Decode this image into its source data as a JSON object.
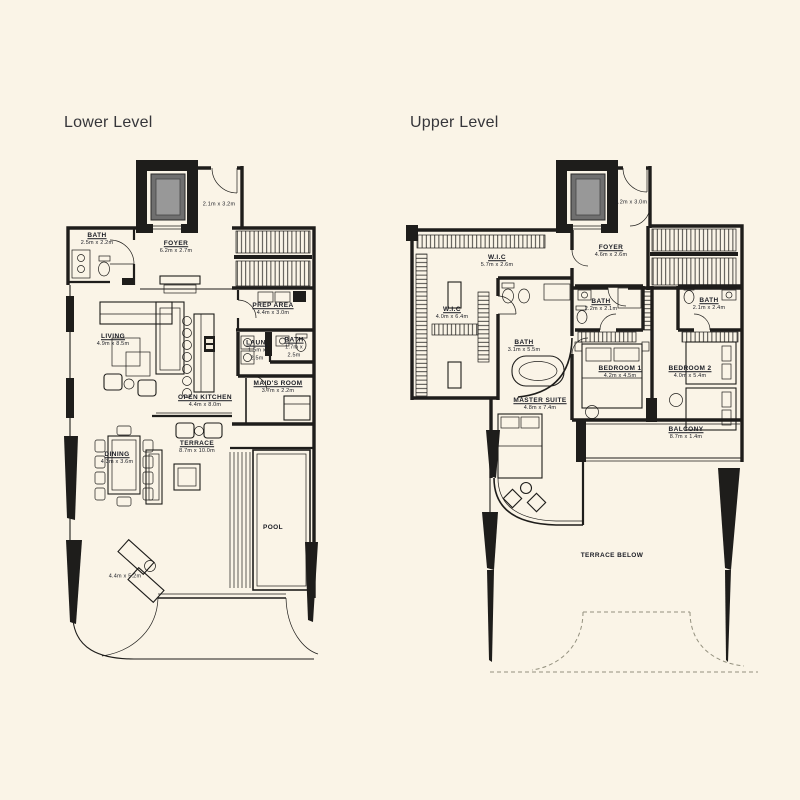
{
  "page": {
    "background": "#FAF4E7",
    "wall_color": "#1e1d1b",
    "elevator_fill": "#6f6f6f",
    "label_color": "#1a1c24"
  },
  "lower": {
    "title": "Lower Level",
    "labels": {
      "bath": {
        "name": "BATH",
        "dim": "2.5m x 2.2m"
      },
      "foyer": {
        "name": "FOYER",
        "dim": "6.2m x 2.7m"
      },
      "lift": {
        "dim": "2.1m x 3.2m"
      },
      "prep": {
        "name": "PREP AREA",
        "dim": "4.4m x 3.0m"
      },
      "living": {
        "name": "LIVING",
        "dim": "4.9m x 8.5m"
      },
      "kitchen": {
        "name": "OPEN KITCHEN",
        "dim": "4.4m x 8.0m"
      },
      "laundry": {
        "name": "LAUN.",
        "dim": "1.5m x 2.5m"
      },
      "bath2": {
        "name": "BATH",
        "dim": "1.7m x 2.5m"
      },
      "maids": {
        "name": "MAID'S ROOM",
        "dim": "3.7m x 2.2m"
      },
      "dining": {
        "name": "DINING",
        "dim": "4.3m x 3.6m"
      },
      "terrace": {
        "name": "TERRACE",
        "dim": "8.7m x 10.0m"
      },
      "pool": {
        "name": "POOL"
      },
      "deck": {
        "dim": "4.4m x 5.2m"
      }
    }
  },
  "upper": {
    "title": "Upper Level",
    "labels": {
      "wic1": {
        "name": "W.I.C",
        "dim": "5.7m x 2.6m"
      },
      "foyer": {
        "name": "FOYER",
        "dim": "4.6m x 2.6m"
      },
      "lift": {
        "dim": "2.2m x 3.0m"
      },
      "wic2": {
        "name": "W.I.C",
        "dim": "4.0m x 6.4m"
      },
      "bath_master": {
        "name": "BATH",
        "dim": "3.1m x 5.5m"
      },
      "master": {
        "name": "MASTER SUITE",
        "dim": "4.8m x 7.4m"
      },
      "bath1": {
        "name": "BATH",
        "dim": "2.2m x 2.1m"
      },
      "bed1": {
        "name": "BEDROOM 1",
        "dim": "4.2m x 4.5m"
      },
      "bath2": {
        "name": "BATH",
        "dim": "2.1m x 2.4m"
      },
      "bed2": {
        "name": "BEDROOM 2",
        "dim": "4.0m x 5.4m"
      },
      "balcony": {
        "name": "BALCONY",
        "dim": "8.7m x 1.4m"
      },
      "terrace_below": {
        "name": "TERRACE BELOW"
      }
    }
  }
}
